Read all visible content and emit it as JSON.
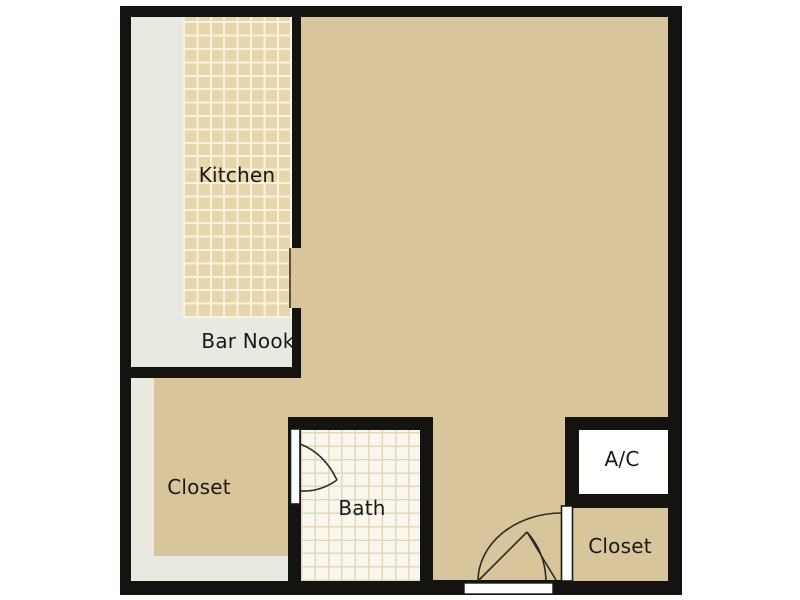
{
  "floorplan": {
    "rooms": {
      "kitchen": {
        "label": "Kitchen"
      },
      "bar_nook": {
        "label": "Bar Nook"
      },
      "closet_left": {
        "label": "Closet"
      },
      "bath": {
        "label": "Bath"
      },
      "ac": {
        "label": "A/C"
      },
      "closet_right": {
        "label": "Closet"
      }
    },
    "features": {
      "doors": [
        "bath-swing-door",
        "entry-swing-door"
      ],
      "openings": [
        "kitchen-pass-through",
        "entry-doorway",
        "right-closet-doorway"
      ]
    },
    "colors": {
      "background": "#ffffff",
      "wall": "#151310",
      "floor_tan": "#d8c59c",
      "counter_gray": "#e9e8e1",
      "kitchen_tile_base": "#e7d5ab",
      "kitchen_tile_line": "#f8f2df",
      "bath_tile_base": "#faf7ef",
      "bath_tile_line": "#e3d8bc",
      "ac_white": "#ffffff",
      "door_stroke": "#2b2a26"
    }
  }
}
